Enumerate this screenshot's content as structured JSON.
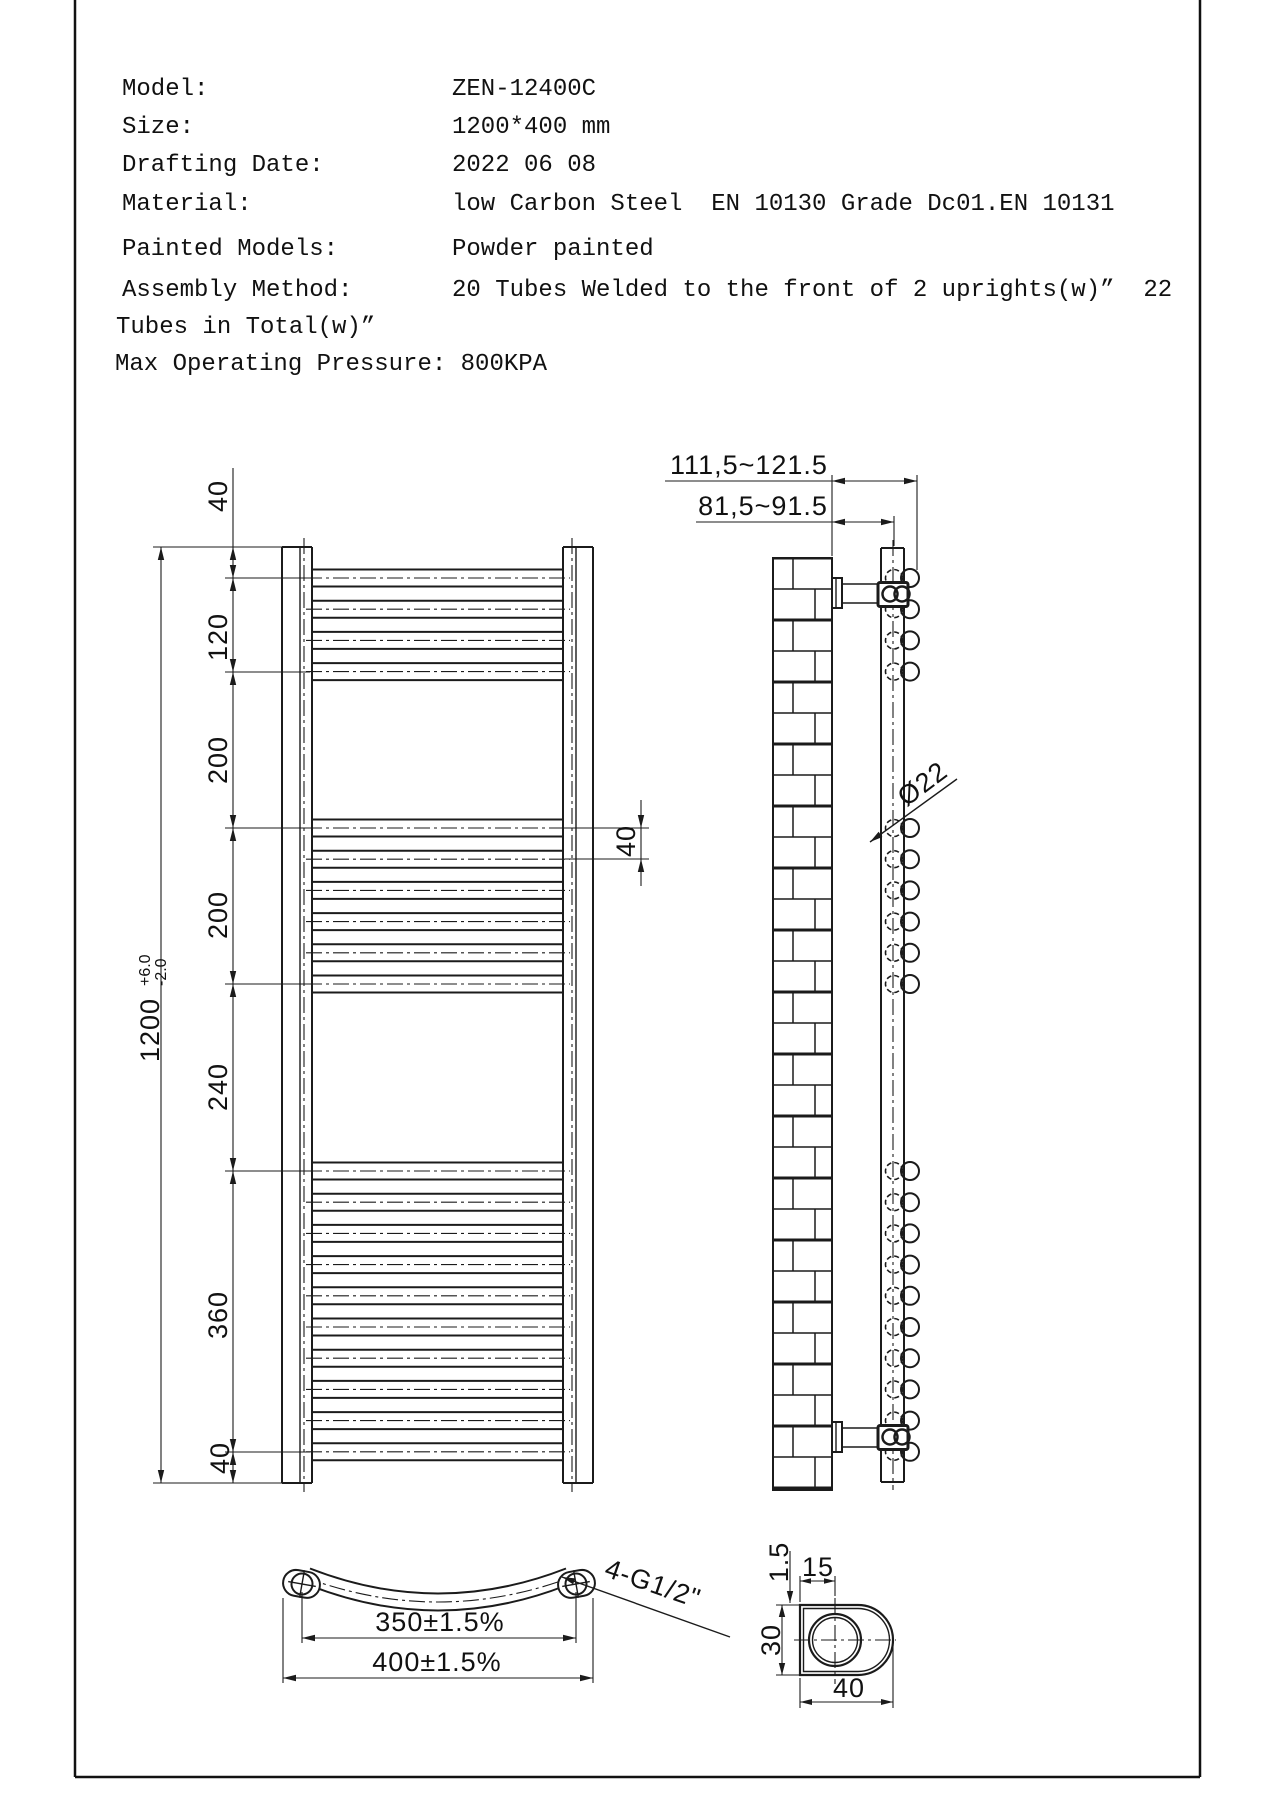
{
  "doc_title": "ZEN-12400C towel radiator technical drawing",
  "header": {
    "rows": [
      {
        "label": "Model:",
        "value": "ZEN-12400C"
      },
      {
        "label": "Size:",
        "value": "1200*400 mm"
      },
      {
        "label": "Drafting Date:",
        "value": "2022 06 08"
      },
      {
        "label": "Material:",
        "value": "low Carbon Steel  EN 10130 Grade Dc01.EN 10131"
      },
      {
        "label": "Painted Models:",
        "value": "Powder painted"
      },
      {
        "label": "Assembly Method:",
        "value": "20 Tubes Welded to the front of 2 uprights(w)”  22"
      }
    ],
    "continuation": "Tubes in Total(w)”",
    "pressure_line": "Max Operating Pressure: 800KPA"
  },
  "front_view": {
    "overall": {
      "value": "1200",
      "tol_plus": "+6.0",
      "tol_minus": "-2.0"
    },
    "segments": [
      "40",
      "120",
      "200",
      "200",
      "240",
      "360",
      "40"
    ],
    "pitch_label": "40",
    "tube_groups": [
      {
        "count": 4,
        "start": 578
      },
      {
        "count": 6,
        "start": 828
      },
      {
        "count": 10,
        "start": 1171
      }
    ],
    "pitch_px": 31.2
  },
  "side_view": {
    "dim_wall_to_front": "111,5~121.5",
    "dim_wall_to_back": "81,5~91.5",
    "tube_diameter": "Ø22"
  },
  "bottom_view": {
    "dim_centers": "350±1.5%",
    "dim_overall": "400±1.5%",
    "thread_label": "4-G1/2\""
  },
  "detail_view": {
    "dim_thickness": "1.5",
    "dim_center_offset": "15",
    "dim_depth": "30",
    "dim_width": "40"
  },
  "colors": {
    "line": "#1b1b1b",
    "text": "#111111",
    "background": "#ffffff"
  }
}
